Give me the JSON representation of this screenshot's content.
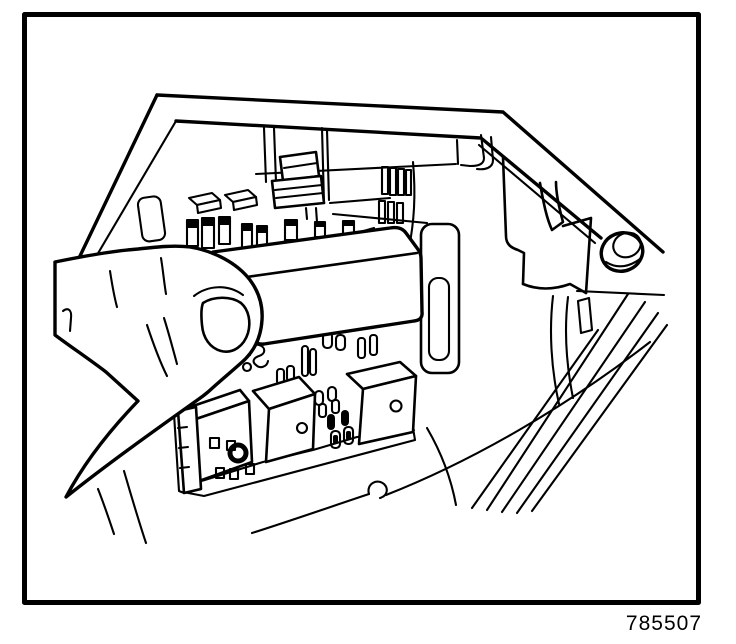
{
  "figure": {
    "number": "785507"
  },
  "canvas": {
    "width": 736,
    "height": 644,
    "background": "#ffffff",
    "ink": "#000000"
  },
  "illustration": {
    "alt_text": "Line-art service illustration: a hand grasping the mini-relay cover inside a vehicle underhood fuse and relay block"
  }
}
